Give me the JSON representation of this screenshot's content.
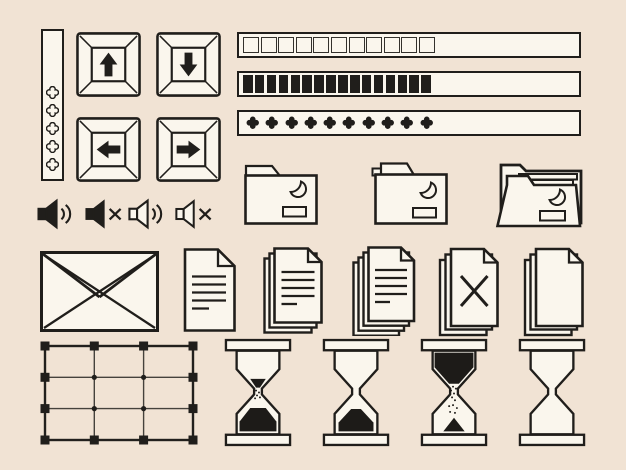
{
  "palette": {
    "background": "#f1e3d4",
    "surface": "#faf6ed",
    "line": "#201e1b",
    "sand": "#1d1b18"
  },
  "indicator_strip": {
    "label": "vertical indicator strip with clover dots",
    "dot_count": 5
  },
  "arrow_keys": {
    "items": [
      {
        "label": "keyboard key up arrow"
      },
      {
        "label": "keyboard key down arrow"
      },
      {
        "label": "keyboard key left arrow"
      },
      {
        "label": "keyboard key right arrow"
      }
    ]
  },
  "progress_bars": {
    "items": [
      {
        "label": "progress bar with outlined square segments",
        "segments": 11
      },
      {
        "label": "progress bar with filled block segments",
        "segments": 16
      },
      {
        "label": "progress bar with filled clover segments",
        "segments": 10
      }
    ]
  },
  "folders": {
    "items": [
      {
        "label": "closed folder with crescent moon emblem and name plate"
      },
      {
        "label": "closed folder with inset tab, crescent moon emblem and name plate"
      },
      {
        "label": "open folder with sheets, crescent moon emblem and name plate"
      }
    ]
  },
  "volume": {
    "items": [
      {
        "label": "speaker sound on, filled"
      },
      {
        "label": "speaker muted, filled"
      },
      {
        "label": "speaker sound on, outline"
      },
      {
        "label": "speaker muted, outline"
      }
    ]
  },
  "mail_documents": {
    "items": [
      {
        "label": "envelope"
      },
      {
        "label": "document page with text lines"
      },
      {
        "label": "stack of three document pages with text lines"
      },
      {
        "label": "stack of four document pages with text lines"
      },
      {
        "label": "document stack with x mark"
      },
      {
        "label": "blank document stack"
      }
    ]
  },
  "table_grid": {
    "label": "table grid with square handles and node dots",
    "columns": 3,
    "rows": 3
  },
  "hourglasses": {
    "items": [
      {
        "label": "hourglass almost finished, sand flowing"
      },
      {
        "label": "hourglass finished, sand at bottom"
      },
      {
        "label": "hourglass just started, sand flowing"
      },
      {
        "label": "hourglass empty"
      }
    ]
  }
}
